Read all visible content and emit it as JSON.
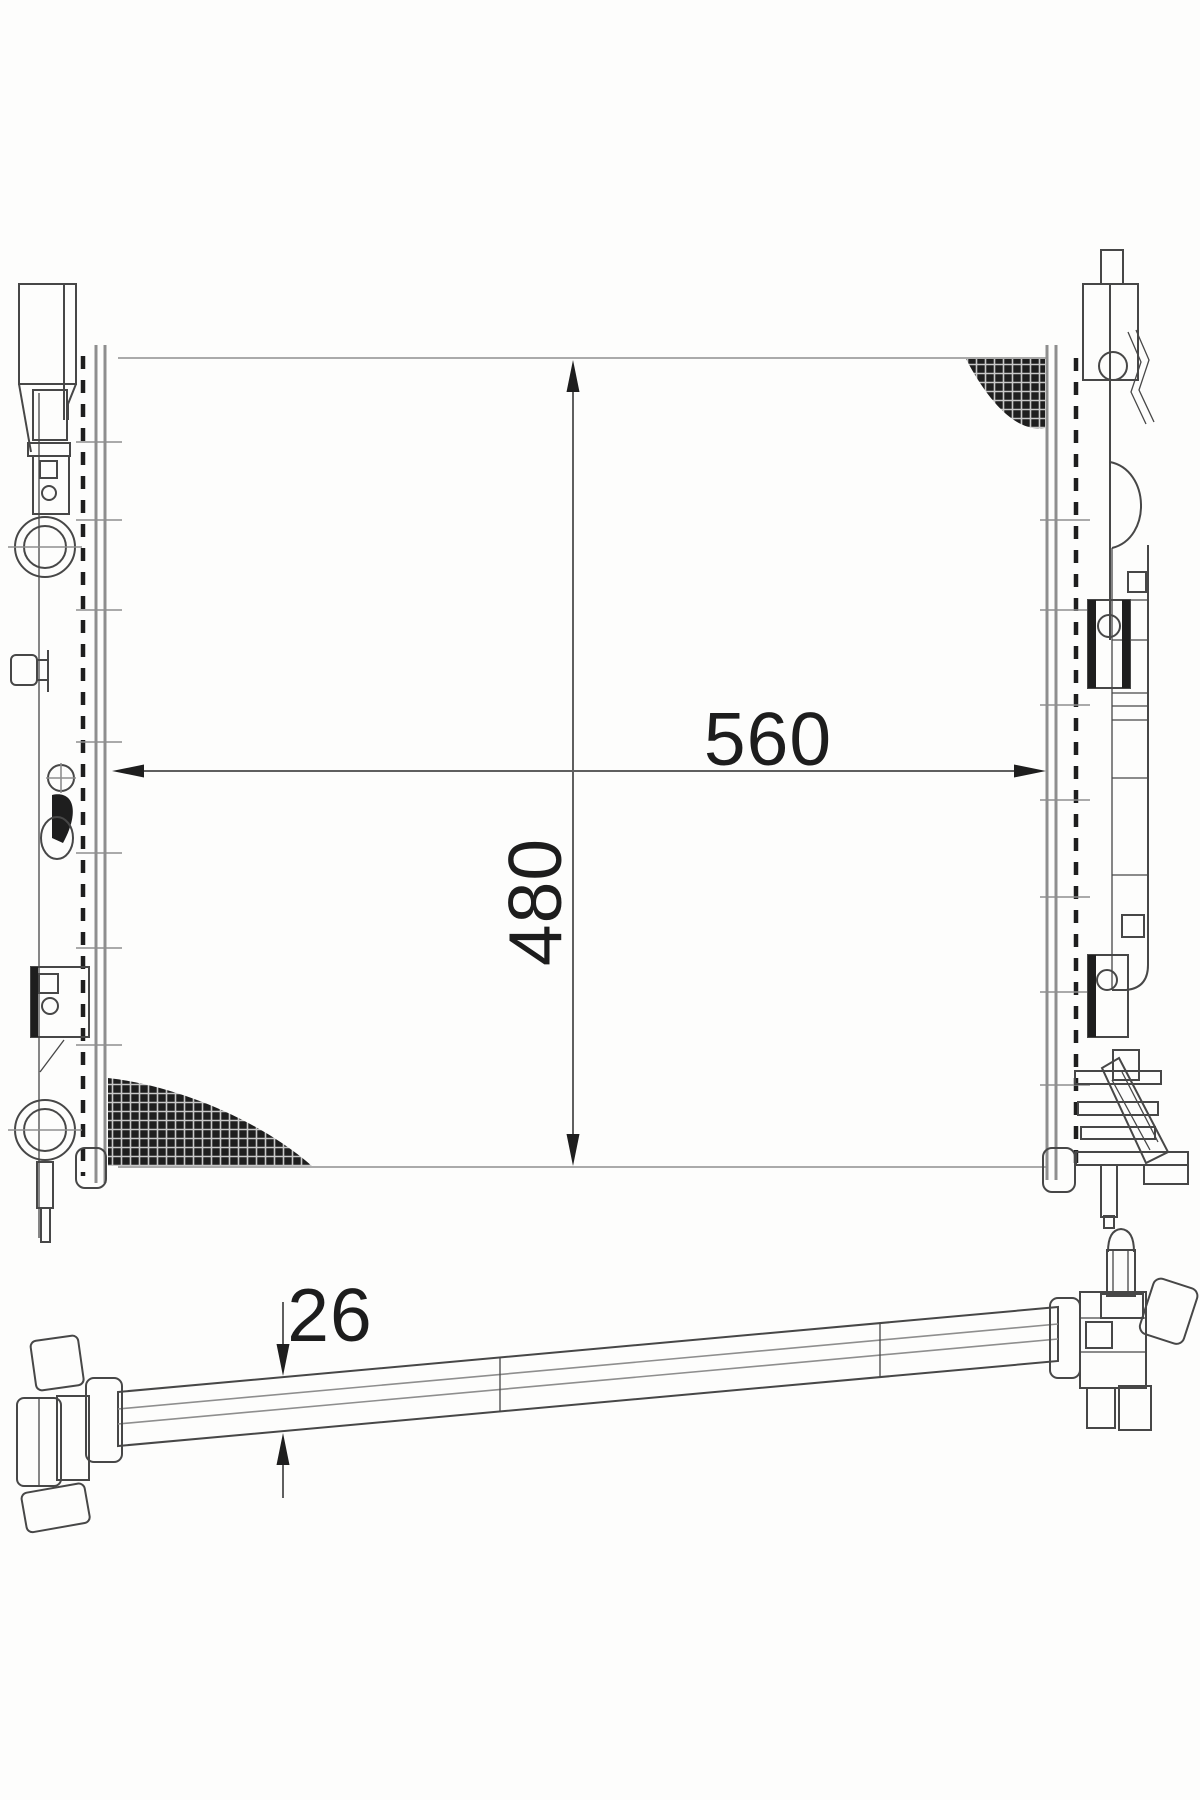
{
  "drawing": {
    "dimensions": {
      "width_label": "560",
      "height_label": "480",
      "thickness_label": "26"
    },
    "colors": {
      "background": "#fdfdfc",
      "line": "#474747",
      "line_light": "#8e8e8e",
      "dimension_line": "#5f5f5f",
      "dark_fill": "#1e1e1e",
      "hatch_grid": "#c8c8c8"
    }
  }
}
